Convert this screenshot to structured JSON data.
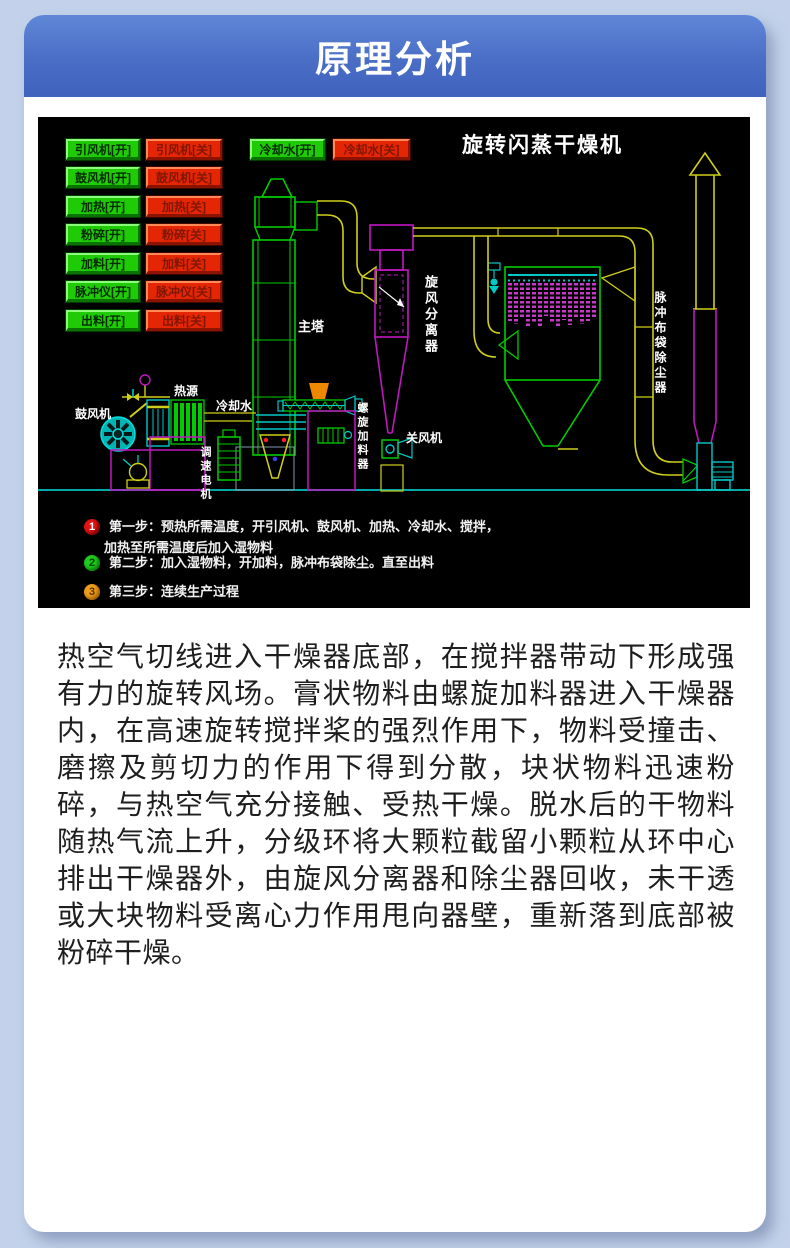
{
  "header": {
    "title": "原理分析"
  },
  "colors": {
    "page_bg": "#c3d2ea",
    "header_gradient_top": "#5f87d7",
    "header_gradient_bottom": "#3f63bd",
    "button_on_green": "#1ecb04",
    "button_off_red": "#e42604",
    "step1_circle": "#e01414",
    "step2_circle": "#1ecb1e",
    "step3_circle": "#f09c1c"
  },
  "diagram": {
    "title": "旋转闪蒸干燥机",
    "buttons_on": [
      "引风机[开]",
      "鼓风机[开]",
      "加热[开]",
      "粉碎[开]",
      "加料[开]",
      "脉冲仪[开]",
      "出料[开]"
    ],
    "buttons_off": [
      "引风机[关]",
      "鼓风机[关]",
      "加热[关]",
      "粉碎[关]",
      "加料[关]",
      "脉冲仪[关]",
      "出料[关]"
    ],
    "cooling_on": "冷却水[开]",
    "cooling_off": "冷却水[关]",
    "labels": {
      "main_tower": "主塔",
      "cyclone": "旋风分离器",
      "bag_filter": "脉冲布袋除尘器",
      "blower": "鼓风机",
      "heat_source": "热源",
      "cooling_water": "冷却水",
      "speed_motor": "调速电机",
      "screw_feeder": "螺旋加料器",
      "air_lock_fan": "关风机"
    },
    "steps": [
      {
        "num": "1",
        "line1": "第一步：预热所需温度，开引风机、鼓风机、加热、冷却水、搅拌，",
        "line2": "加热至所需温度后加入湿物料"
      },
      {
        "num": "2",
        "line1": "第二步：加入湿物料，开加料，脉冲布袋除尘。直至出料"
      },
      {
        "num": "3",
        "line1": "第三步：连续生产过程"
      }
    ]
  },
  "body_text": "热空气切线进入干燥器底部，在搅拌器带动下形成强有力的旋转风场。膏状物料由螺旋加料器进入干燥器内，在高速旋转搅拌桨的强烈作用下，物料受撞击、磨擦及剪切力的作用下得到分散，块状物料迅速粉碎，与热空气充分接触、受热干燥。脱水后的干物料随热气流上升，分级环将大颗粒截留小颗粒从环中心排出干燥器外，由旋风分离器和除尘器回收，未干透或大块物料受离心力作用甩向器壁，重新落到底部被粉碎干燥。"
}
